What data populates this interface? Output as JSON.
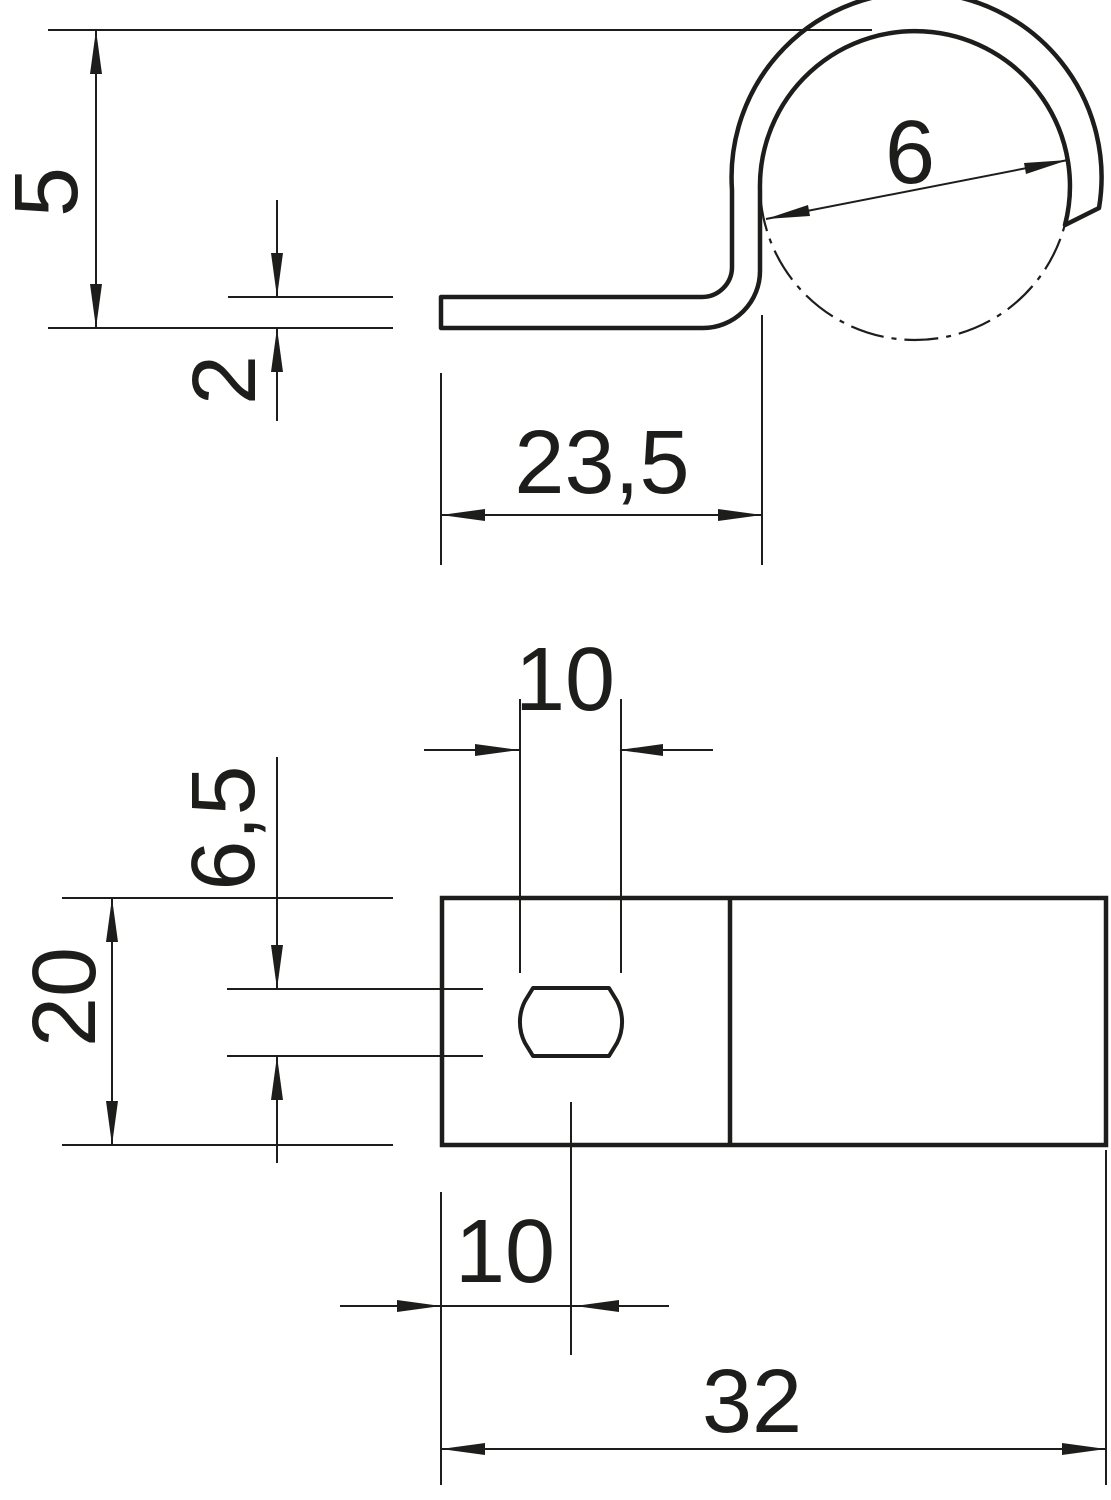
{
  "drawing": {
    "type": "technical-dimension-drawing",
    "background": "#ffffff",
    "line_color": "#1d1d1b",
    "side_view": {
      "description": "side profile of clip with loop",
      "label_height": "5",
      "label_thickness": "2",
      "label_loop_diameter": "6",
      "label_base_length": "23,5"
    },
    "plan_view": {
      "description": "plan view of base plate with slot",
      "label_slot_length": "10",
      "label_slot_width": "6,5",
      "label_plate_width": "20",
      "label_slot_offset": "10",
      "label_plate_length": "32"
    }
  }
}
